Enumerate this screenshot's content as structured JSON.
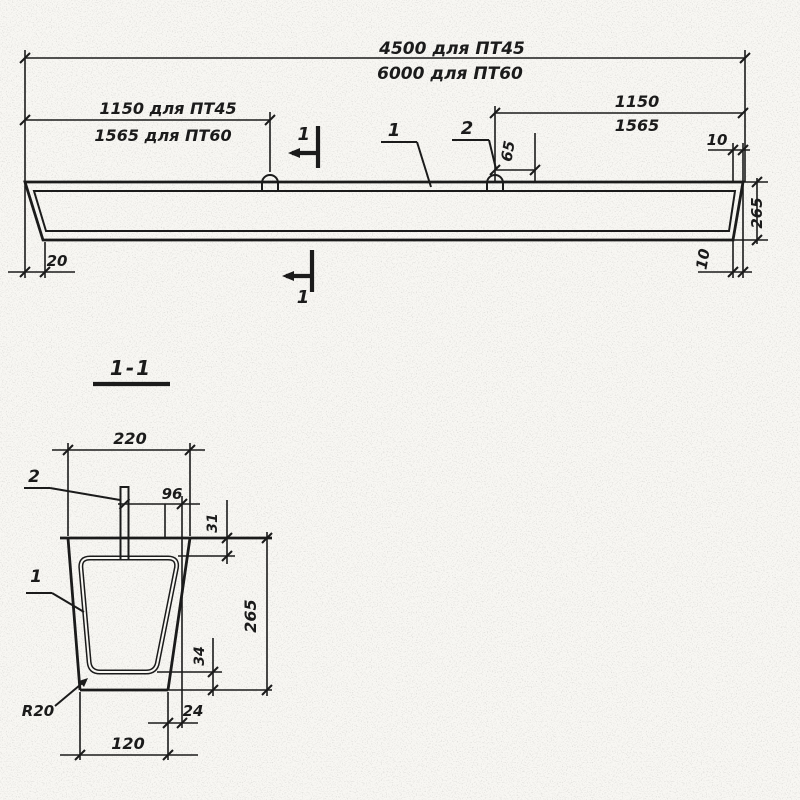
{
  "drawing": {
    "ink_color": "#1b1b1b",
    "paper_color": "#f8f7f3",
    "elevation": {
      "dim_length_pt45": "4500 для ПТ45",
      "dim_length_pt60": "6000 для ПТ60",
      "dim_loop_left_line1": "1150 для ПТ45",
      "dim_loop_left_line2": "1565 для ПТ60",
      "dim_loop_right_line1": "1150",
      "dim_loop_right_line2": "1565",
      "dim_loop_offset": "65",
      "dim_end_top": "10",
      "dim_height": "265",
      "dim_end_bottom": "10",
      "dim_end_left": "20",
      "callout_frame": "1",
      "callout_loop": "2",
      "section_mark_top": "1",
      "section_mark_bottom": "1"
    },
    "section": {
      "title": "1-1",
      "dim_width_top": "220",
      "dim_bar_offset": "96",
      "dim_top_cover": "31",
      "dim_height": "265",
      "dim_bottom_cover": "34",
      "dim_corner_offset": "24",
      "dim_width_bottom": "120",
      "radius_label": "R20",
      "callout_frame": "1",
      "callout_loop": "2"
    }
  }
}
